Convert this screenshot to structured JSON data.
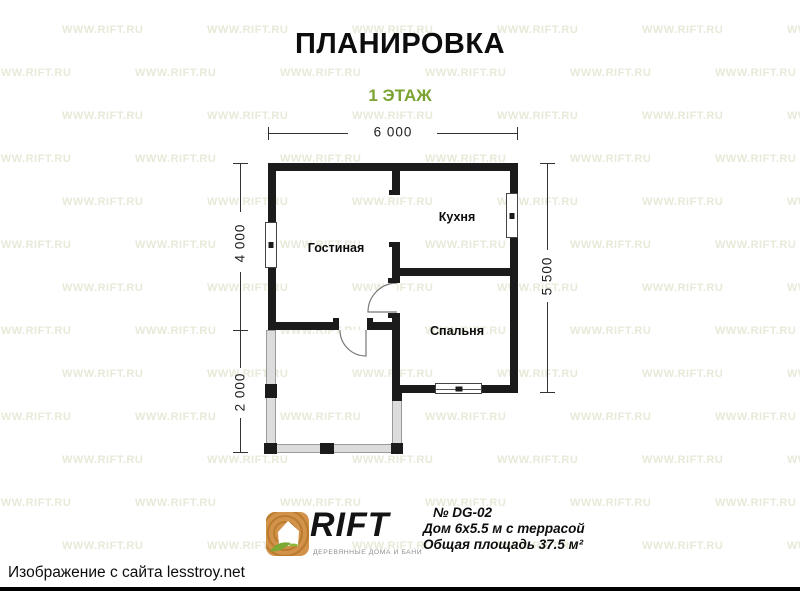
{
  "page": {
    "title": "ПЛАНИРОВКА",
    "subtitle": "1 ЭТАЖ"
  },
  "watermark": {
    "text": "WWW.RIFT.RU"
  },
  "plan": {
    "dimensions": {
      "top": "6 000",
      "left_upper": "4 000",
      "left_lower": "2 000",
      "right": "5 500"
    },
    "rooms": [
      {
        "label": "Гостиная"
      },
      {
        "label": "Кухня"
      },
      {
        "label": "Спальня"
      }
    ]
  },
  "footer": {
    "brand": "RIFT",
    "tagline": "ДЕРЕВЯННЫЕ ДОМА И БАНИ",
    "model_number": "№ DG-02",
    "model_name": "Дом 6х5.5 м с террасой",
    "model_area": "Общая площадь 37.5 м²"
  },
  "caption": "Изображение с сайта lesstroy.net",
  "colors": {
    "accent_green": "#7ba331",
    "wall_black": "#1b1b1b",
    "terrace_gray": "#dcdcdc",
    "watermark_tint": "#e8e9d8",
    "brand_wood": "#d2924a",
    "brand_ring": "#b97c2f",
    "brand_leaf": "#7aa832",
    "brand_dark": "#141414",
    "tagline_gray": "#8f8f8f"
  }
}
